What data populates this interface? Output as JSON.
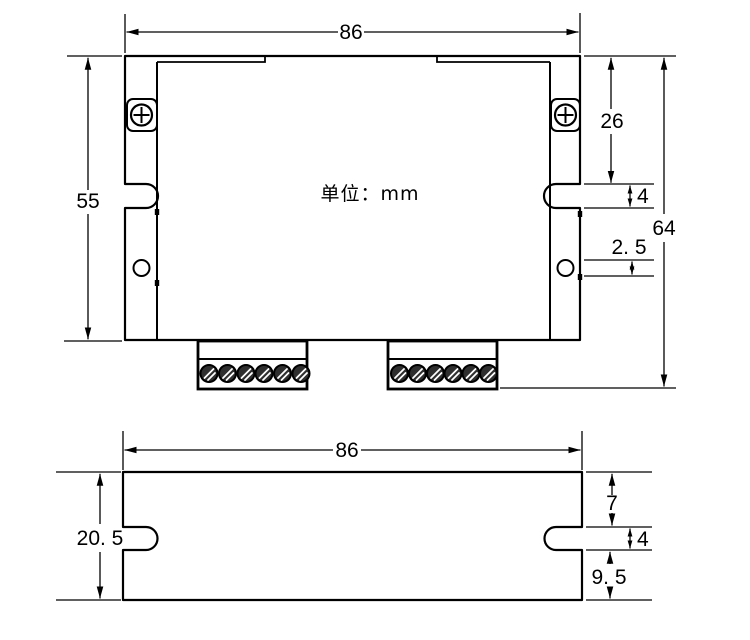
{
  "drawing": {
    "unit_label": "单位：mm",
    "colors": {
      "line": "#000000",
      "background": "#ffffff"
    },
    "top_view": {
      "dim_width": "86",
      "dim_body_height": "55",
      "dim_top_to_slot": "26",
      "dim_slot_width": "4",
      "dim_hole_diameter": "2. 5",
      "dim_overall_height": "64"
    },
    "bottom_view": {
      "dim_width": "86",
      "dim_height": "20. 5",
      "dim_top_to_slot": "7",
      "dim_slot_width": "4",
      "dim_slot_to_bottom": "9. 5"
    }
  }
}
